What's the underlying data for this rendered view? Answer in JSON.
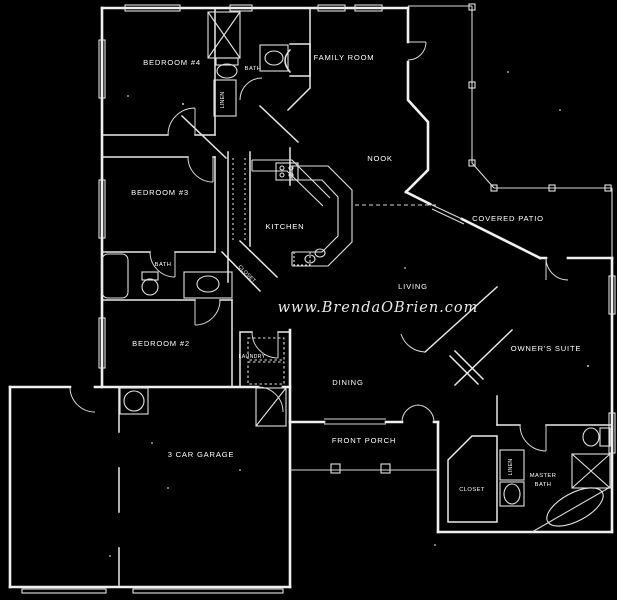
{
  "canvas": {
    "background_color": "#000000",
    "wall_color": "#f0f0f0",
    "text_color": "#ffffff"
  },
  "watermark": {
    "text": "www.BrendaOBrien.com"
  },
  "labels": {
    "bedroom4": "BEDROOM #4",
    "bath_upper": "BATH",
    "family_room": "FAMILY ROOM",
    "nook": "NOOK",
    "kitchen": "KITCHEN",
    "covered_patio": "COVERED PATIO",
    "bedroom3": "BEDROOM #3",
    "bath_hall": "BATH",
    "living": "LIVING",
    "bedroom2": "BEDROOM #2",
    "laundry": "LAUNDRY",
    "closet_hall": "CLOSET",
    "dining": "DINING",
    "owners_suite": "OWNER'S SUITE",
    "garage": "3 CAR GARAGE",
    "front_porch": "FRONT PORCH",
    "closet_master": "CLOSET",
    "master_bath_line1": "MASTER",
    "master_bath_line2": "BATH",
    "linen_upper": "LINEN",
    "linen_master": "LINEN"
  }
}
